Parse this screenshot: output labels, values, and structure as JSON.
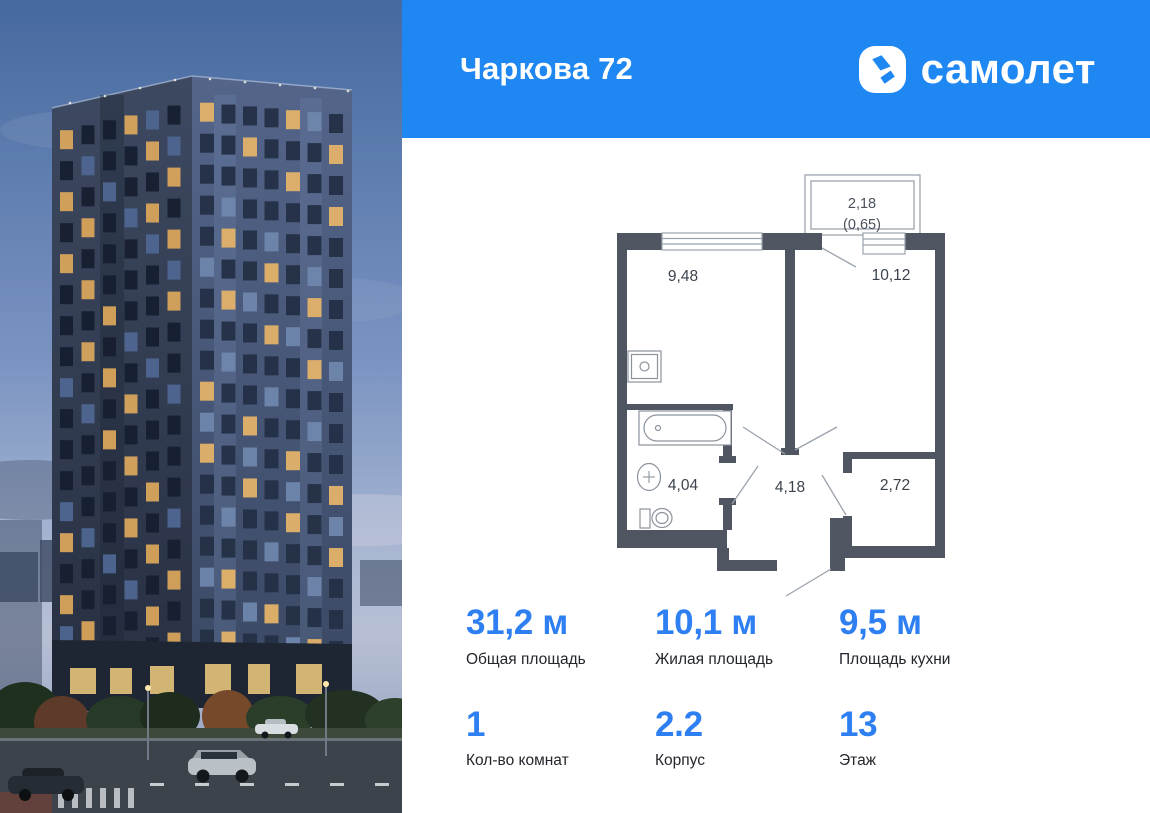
{
  "header": {
    "title": "Чаркова 72",
    "brand": "самолет",
    "brand_color": "#1f87f2",
    "brand_mark_icon": "samolet-arrow-icon"
  },
  "floorplan": {
    "wall_color": "#4f5661",
    "balcony": {
      "area": "2,18",
      "area_reduced": "(0,65)"
    },
    "rooms": [
      {
        "name": "kitchen",
        "area": "9,48"
      },
      {
        "name": "living-room",
        "area": "10,12"
      },
      {
        "name": "bathroom",
        "area": "4,04"
      },
      {
        "name": "hallway",
        "area": "4,18"
      },
      {
        "name": "wardrobe",
        "area": "2,72"
      }
    ],
    "fixture_icons": [
      "kitchen-sink-icon",
      "bathtub-icon",
      "washbasin-icon",
      "toilet-icon"
    ]
  },
  "stats": {
    "accent_color": "#2e7ff1",
    "primary": [
      {
        "value": "31,2 м",
        "label": "Общая площадь"
      },
      {
        "value": "10,1 м",
        "label": "Жилая площадь"
      },
      {
        "value": "9,5 м",
        "label": "Площадь кухни"
      }
    ],
    "secondary": [
      {
        "value": "1",
        "label": "Кол-во комнат"
      },
      {
        "value": "2.2",
        "label": "Корпус"
      },
      {
        "value": "13",
        "label": "Этаж"
      }
    ]
  }
}
